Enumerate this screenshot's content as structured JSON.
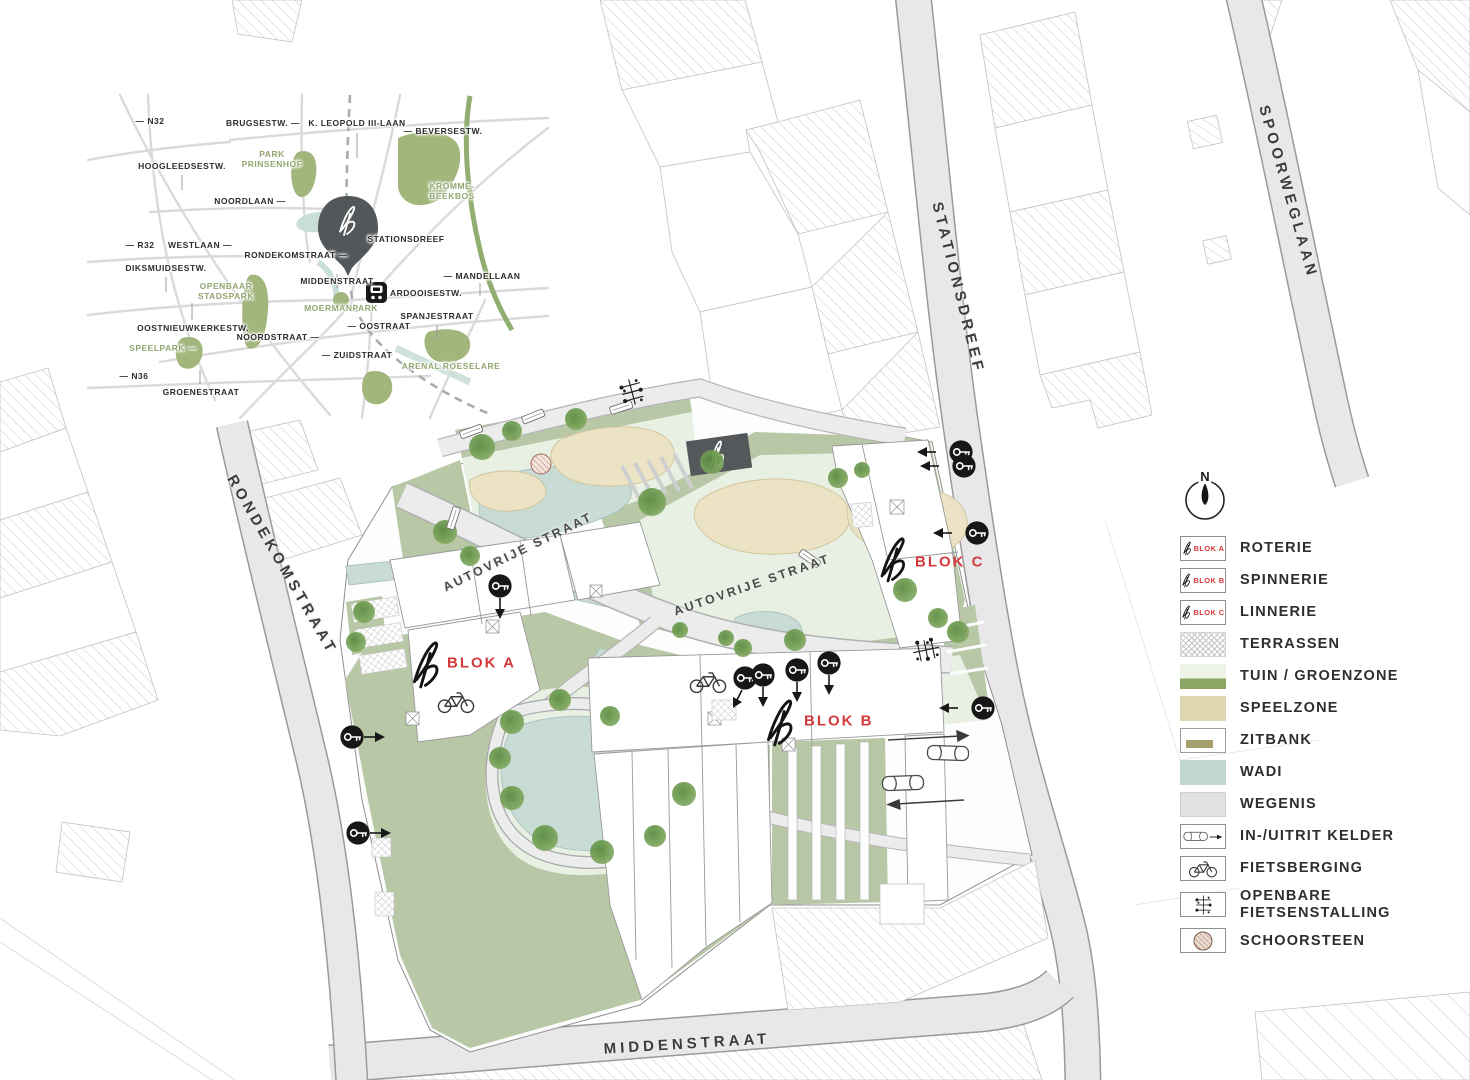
{
  "colors": {
    "accent_red": "#d23a3c",
    "green_dark": "#8ca765",
    "green_sage": "#b8c7a6",
    "lawn_light": "#e8efe3",
    "wadi_teal": "#c8dcd5",
    "sand": "#ece3c4",
    "street_gray": "#e8e8ea",
    "olive_bench": "#a49e6d",
    "dark_cabin": "#54585b"
  },
  "inset": {
    "n32": "— N32",
    "brugsestw": "BRUGSESTW. —",
    "kleopold": "K. LEOPOLD III-LAAN",
    "beversestw": "— BEVERSESTW.",
    "hoogleedsestw": "HOOGLEEDSESTW.",
    "park_prinsenhof": "PARK PRINSENHOF",
    "krommebeekbos": "KROMME- BEEKBOS",
    "noordlaan": "NOORDLAAN —",
    "stationsdreef": "STATIONSDREEF",
    "r32": "— R32",
    "westlaan": "WESTLAAN —",
    "rondekomstraat": "RONDEKOMSTRAAT —",
    "diksmuidsestw": "DIKSMUIDSESTW.",
    "openbaar_stadspark": "OPENBAAR STADSPARK",
    "middenstraat": "MIDDENSTRAAT",
    "mandellaan": "— MANDELLAAN",
    "ardooisestw": "ARDOOISESTW.",
    "moermanpark": "MOERMANPARK",
    "spanjestraat": "SPANJESTRAAT",
    "oostraat": "— OOSTRAAT",
    "oostnieuwkerkestw": "OOSTNIEUWKERKESTW.",
    "noordstraat": "NOORDSTRAAT —",
    "speelpark": "SPEELPARK —",
    "zuidstraat": "— ZUIDSTRAAT",
    "arenal": "ARENAL ROESELARE",
    "n36": "— N36",
    "groenestraat": "GROENESTRAAT"
  },
  "site": {
    "rondekomstraat": "RONDEKOMSTRAAT",
    "stationsdreef": "STATIONSDREEF",
    "spoorweglaan": "SPOORWEGLAAN",
    "middenstraat": "MIDDENSTRAAT",
    "autovrije1": "AUTOVRIJE STRAAT",
    "autovrije2": "AUTOVRIJE STRAAT",
    "blok_a": "BLOK A",
    "blok_b": "BLOK B",
    "blok_c": "BLOK C"
  },
  "legend": {
    "north": "N",
    "items": [
      {
        "chip": "BLOK A",
        "label": "ROTERIE"
      },
      {
        "chip": "BLOK B",
        "label": "SPINNERIE"
      },
      {
        "chip": "BLOK C",
        "label": "LINNERIE"
      },
      {
        "label": "TERRASSEN"
      },
      {
        "label": "TUIN / GROENZONE"
      },
      {
        "label": "SPEELZONE"
      },
      {
        "label": "ZITBANK"
      },
      {
        "label": "WADI"
      },
      {
        "label": "WEGENIS"
      },
      {
        "label": "IN-/UITRIT KELDER"
      },
      {
        "label": "FIETSBERGING"
      },
      {
        "label": "OPENBARE FIETSENSTALLING"
      },
      {
        "label": "SCHOORSTEEN"
      }
    ]
  }
}
